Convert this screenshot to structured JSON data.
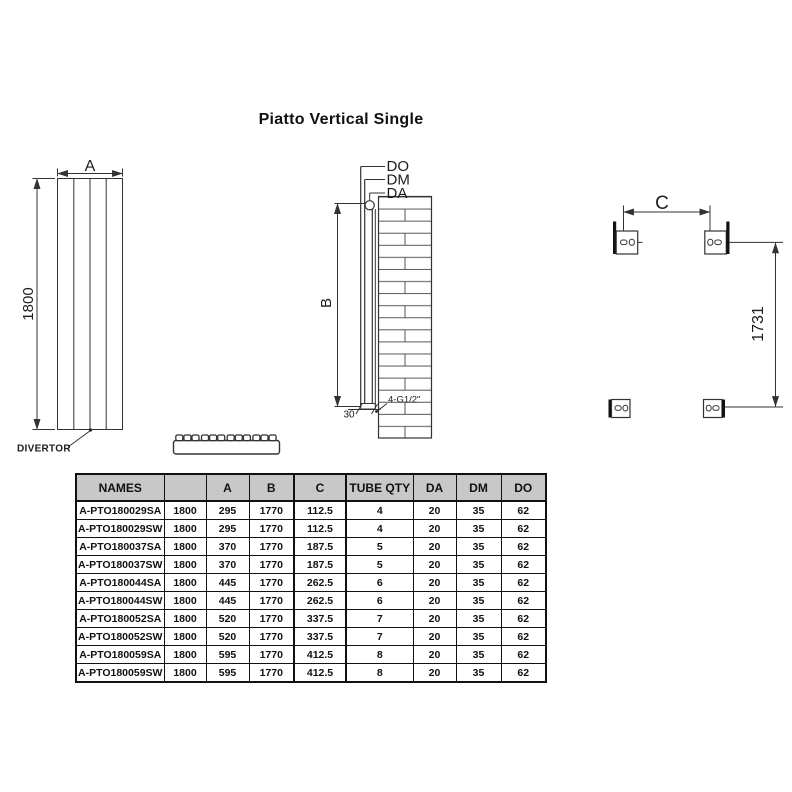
{
  "title": "Piatto Vertical Single",
  "drawings": {
    "front_view": {
      "width_dim_label": "A",
      "height_dim_label": "1800",
      "divertor_label": "DIVERTOR"
    },
    "side_view": {
      "outer_diameter_label": "DO",
      "middle_diameter_label": "DM",
      "inner_diameter_label": "DA",
      "tube_height_dim_label": "B",
      "bottom_offset_label": "30",
      "connection_label": "4-G1/2\""
    },
    "mounting_view": {
      "bracket_spacing_label": "C",
      "bracket_height_label": "1731"
    }
  },
  "table": {
    "headers": [
      "NAMES",
      "",
      "A",
      "B",
      "C",
      "TUBE QTY",
      "DA",
      "DM",
      "DO"
    ],
    "rows": [
      [
        "A-PTO180029SA",
        "1800",
        "295",
        "1770",
        "112.5",
        "4",
        "20",
        "35",
        "62"
      ],
      [
        "A-PTO180029SW",
        "1800",
        "295",
        "1770",
        "112.5",
        "4",
        "20",
        "35",
        "62"
      ],
      [
        "A-PTO180037SA",
        "1800",
        "370",
        "1770",
        "187.5",
        "5",
        "20",
        "35",
        "62"
      ],
      [
        "A-PTO180037SW",
        "1800",
        "370",
        "1770",
        "187.5",
        "5",
        "20",
        "35",
        "62"
      ],
      [
        "A-PTO180044SA",
        "1800",
        "445",
        "1770",
        "262.5",
        "6",
        "20",
        "35",
        "62"
      ],
      [
        "A-PTO180044SW",
        "1800",
        "445",
        "1770",
        "262.5",
        "6",
        "20",
        "35",
        "62"
      ],
      [
        "A-PTO180052SA",
        "1800",
        "520",
        "1770",
        "337.5",
        "7",
        "20",
        "35",
        "62"
      ],
      [
        "A-PTO180052SW",
        "1800",
        "520",
        "1770",
        "337.5",
        "7",
        "20",
        "35",
        "62"
      ],
      [
        "A-PTO180059SA",
        "1800",
        "595",
        "1770",
        "412.5",
        "8",
        "20",
        "35",
        "62"
      ],
      [
        "A-PTO180059SW",
        "1800",
        "595",
        "1770",
        "412.5",
        "8",
        "20",
        "35",
        "62"
      ]
    ]
  },
  "colors": {
    "line": "#333333",
    "dark": "#111111",
    "header_bg": "#c8c8c8"
  }
}
